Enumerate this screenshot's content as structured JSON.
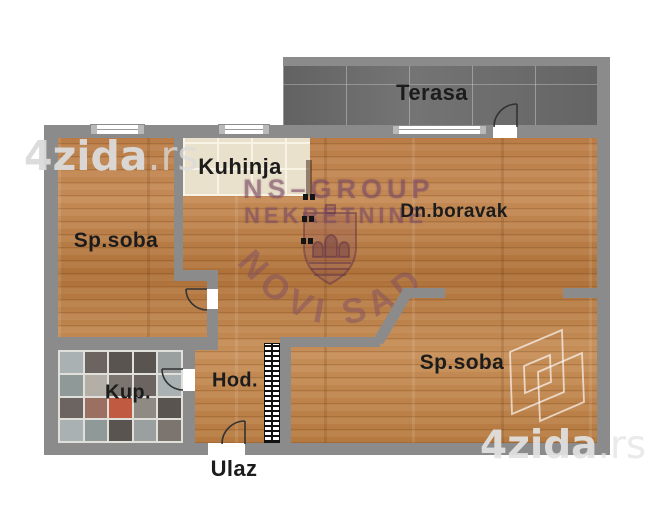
{
  "plan": {
    "rooms": {
      "terrace": {
        "label": "Terasa"
      },
      "kitchen": {
        "label": "Kuhinja"
      },
      "living_room": {
        "label": "Dn.boravak"
      },
      "bedroom_left": {
        "label": "Sp.soba"
      },
      "bedroom_right": {
        "label": "Sp.soba"
      },
      "bathroom": {
        "label": "Kup."
      },
      "hallway": {
        "label": "Hod."
      },
      "entrance": {
        "label": "Ulaz"
      }
    }
  },
  "watermarks": {
    "brand_top_left": {
      "main": "4zida",
      "suffix": ".rs"
    },
    "brand_bottom_right": {
      "main": "4zida",
      "suffix": ".rs"
    },
    "agency": {
      "line1": "NS–GROUP",
      "line2": "NEKRETNINE",
      "city": "NOVI SAD"
    }
  },
  "palette": {
    "wall": "#8b8b8b",
    "wood_floor": "#bb7f4c",
    "kitchen_tile": "#e9e1cb",
    "terrace_tile": "#6d6d6d",
    "bathroom_grout": "#e0dfda",
    "label_text": "#1c1c1c",
    "watermark_gray": "#d6d6d6",
    "agency_purple": "#7a4a64"
  },
  "bathroom_tiles": [
    [
      "#a9b1b3",
      "#6b6460",
      "#59544f",
      "#59544f",
      "#9aa0a0"
    ],
    [
      "#8f9997",
      "#b3aea6",
      "#7c746e",
      "#6b6460",
      "#a9b1b3"
    ],
    [
      "#6b6460",
      "#9b6f62",
      "#c05a40",
      "#8f8a84",
      "#59544f"
    ],
    [
      "#a9b1b3",
      "#8f9997",
      "#59544f",
      "#9aa0a0",
      "#7c746e"
    ]
  ]
}
